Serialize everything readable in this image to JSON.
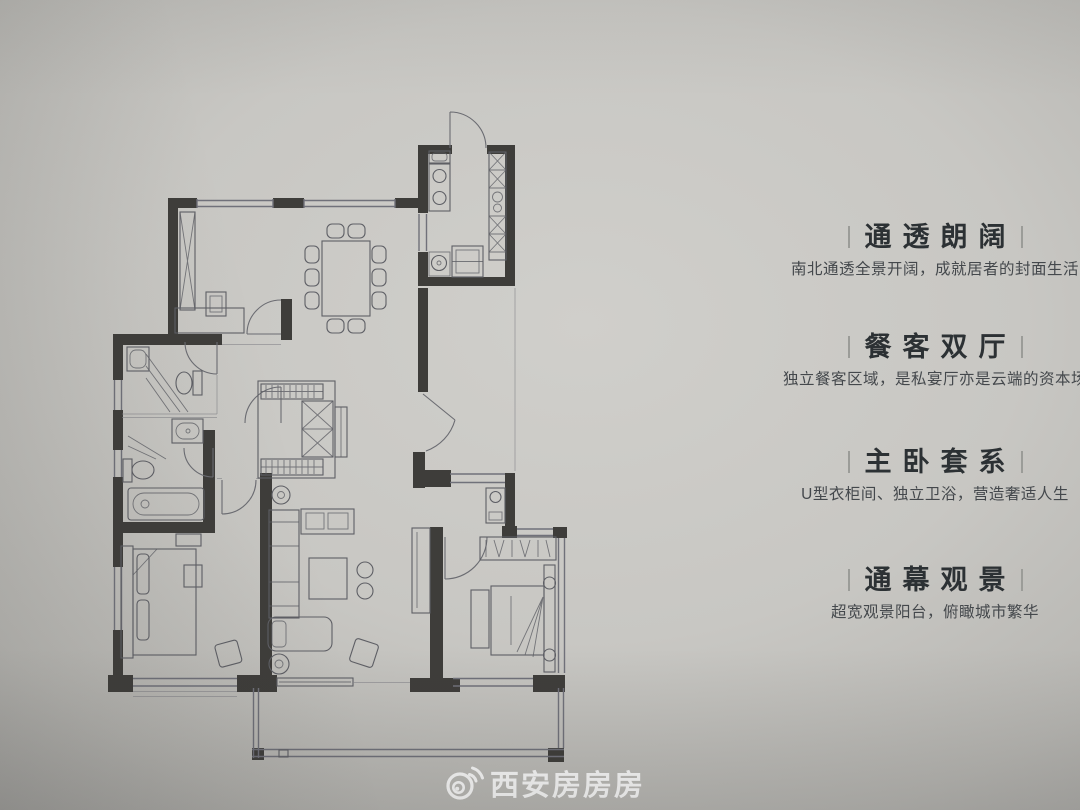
{
  "theme": {
    "paper": "#c8c7c3",
    "paper_light": "#d0cfcb",
    "wall": "#3e3d3a",
    "line": "#5e5f65",
    "window": "#70717a",
    "heading": "#2c3134",
    "body_text": "#44484c",
    "watermark": "#ffffff"
  },
  "features": {
    "items": [
      {
        "title": "通透朗阔",
        "desc": "南北通透全景开阔，成就居者的封面生活"
      },
      {
        "title": "餐客双厅",
        "desc": "独立餐客区域，是私宴厅亦是云端的资本场"
      },
      {
        "title": "主卧套系",
        "desc": "U型衣柜间、独立卫浴，营造奢适人生"
      },
      {
        "title": "通幕观景",
        "desc": "超宽观景阳台，俯瞰城市繁华"
      }
    ]
  },
  "watermark": {
    "logo_icon": "weibo-eye-icon",
    "text": "西安房房房"
  },
  "floor_plan": {
    "type": "apartment-floorplan-line-drawing",
    "regions": [
      "study-bedroom-top-left",
      "dining-room",
      "kitchen",
      "entry-corridor",
      "guest-bathroom",
      "master-bathroom",
      "walk-in-closet",
      "living-room",
      "master-bedroom",
      "second-bedroom",
      "balcony"
    ]
  }
}
